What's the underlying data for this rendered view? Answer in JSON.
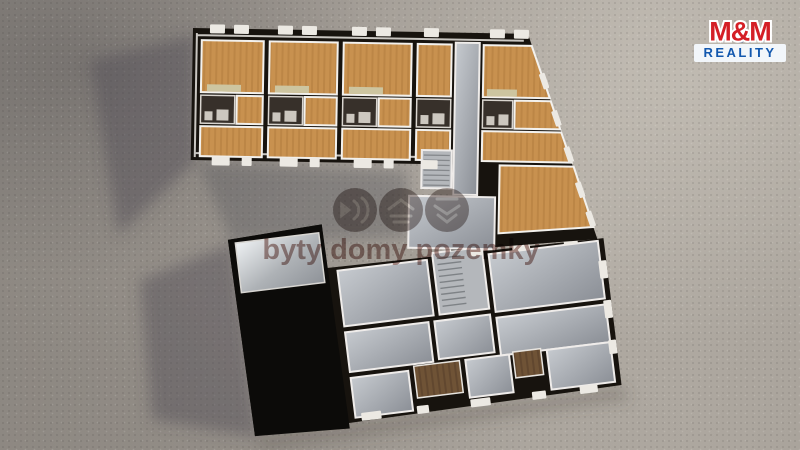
{
  "watermark": {
    "text": "byty domy pozemky",
    "icons": [
      "fast-forward-icon",
      "chevrons-up-icon",
      "chevrons-down-icon"
    ]
  },
  "logo": {
    "top": "M&M",
    "bottom": "REALITY"
  },
  "colors": {
    "ground": "#a29c95",
    "ground_light": "#b2aca4",
    "ground_dark": "#8d8882",
    "wall_dark": "#17130e",
    "wall_white": "#ece9e3",
    "wood_floor": "#c8914f",
    "wood_floor_dark": "#ad793c",
    "wood_tile_brown": "#6f5336",
    "wood_tile_brown_dark": "#58402a",
    "concrete_light": "#c6cacf",
    "concrete_dark": "#8b8f96",
    "shine_light": "#eef1f3",
    "roof_black": "#0c0b09",
    "stair_gray": "#b4b7bb",
    "bath_dark": "#37302a",
    "bed_tan": "#cdc5a0",
    "watermark_tint": "#6e3a32",
    "logo_red": "#d41f26",
    "logo_blue": "#1358ae",
    "logo_shadow": "#1c3a8a",
    "logo_bg": "#f2f6fa"
  }
}
